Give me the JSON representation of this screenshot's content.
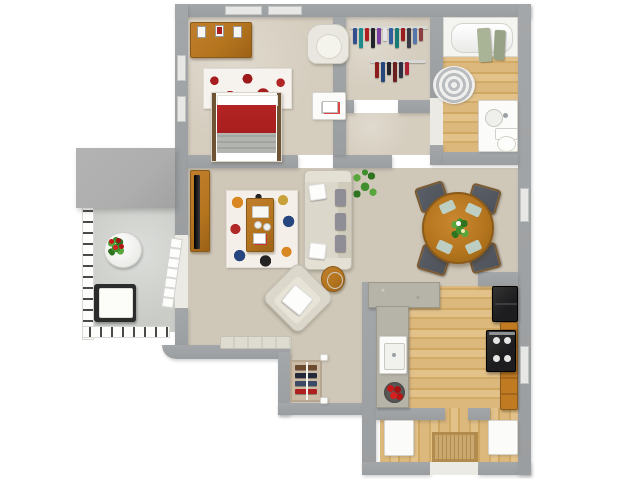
{
  "meta": {
    "type": "3d-floor-plan-render",
    "description": "Top-down 3D rendering of a one-bedroom, one-bathroom apartment floor plan with balcony; no text labels are visible in the image"
  },
  "colors": {
    "bg": "#ffffff",
    "wall": "#a4a7a9",
    "window": "#e7e8e6",
    "carpet": "#d5cdbe",
    "carpet_shade": "#cfc7b8",
    "wood_floor": "#ddb87c",
    "wood_furniture": "#b5751f",
    "cabinet": "#bf7a22",
    "concrete": "#c9ccc7",
    "roof": "#aeaeae",
    "accent_red": "#a81e1e",
    "sofa": "#dbd7cb",
    "cushion_gray": "#8f8e96",
    "plant_green": "#3f8f2f",
    "appliance": "#1d1d1f",
    "granite": "#b6b3a9",
    "towel": "#a9b395",
    "chair_dark": "#4e525a",
    "placemat": "#bcd8d4",
    "mat": "#c9a96f",
    "white_goods": "#fbfbf9"
  },
  "plan": {
    "rooms": [
      {
        "name": "bedroom",
        "floor": "carpet",
        "items": [
          "dresser with picture frames",
          "bed with red blanket and gray throw",
          "red floral area rug",
          "tub armchair",
          "ottoman with magazines",
          "windows"
        ]
      },
      {
        "name": "walk-in-closet",
        "floor": "carpet",
        "items": [
          "two clothes rails with hanging clothes"
        ]
      },
      {
        "name": "bathroom",
        "floor": "wood",
        "items": [
          "bathtub",
          "hanging green towels",
          "striped round rug",
          "vanity with sink",
          "toilet"
        ]
      },
      {
        "name": "hallway",
        "floor": "carpet",
        "items": []
      },
      {
        "name": "living-room",
        "floor": "carpet",
        "items": [
          "tv stand with flat tv",
          "multicolor floral rug",
          "wood coffee table with tray",
          "beige sofa with pillows",
          "potted plant",
          "angled accent chair",
          "side table with lamp",
          "low bench"
        ]
      },
      {
        "name": "dining-area",
        "floor": "carpet",
        "items": [
          "round wood dining table",
          "four dark chairs",
          "flower centerpiece",
          "four blue placemats"
        ]
      },
      {
        "name": "kitchen",
        "floor": "wood",
        "items": [
          "granite counter peninsula",
          "granite side counter",
          "sink",
          "bowl of red apples",
          "black refrigerator",
          "black range stove",
          "wood cabinets",
          "window"
        ]
      },
      {
        "name": "entry",
        "floor": "wood",
        "items": [
          "shoe closet with shoe rack",
          "woven doormat",
          "open white door panels",
          "front door opening"
        ]
      },
      {
        "name": "balcony",
        "floor": "concrete",
        "items": [
          "metal railing",
          "round white table",
          "red flower pot",
          "patio chair with white cushion",
          "gray roof overhang",
          "paned balcony door"
        ]
      }
    ],
    "clothes_rail_1": [
      "#33508e",
      "#1f8a8a",
      "#b02020",
      "#23232b",
      "#7a3fa0",
      "#e4e4e8",
      "#355e9e",
      "#177a74",
      "#991d1d",
      "#3a3a46",
      "#5577aa",
      "#8a4040"
    ],
    "clothes_rail_2": [
      "#8b1d1d",
      "#26477e",
      "#23232b",
      "#6b1f1f",
      "#2e2e44",
      "#aa2233"
    ],
    "shoe_shelves": [
      "#6b4a2f",
      "#23293a",
      "#3a4a66",
      "#b01f1f"
    ]
  }
}
